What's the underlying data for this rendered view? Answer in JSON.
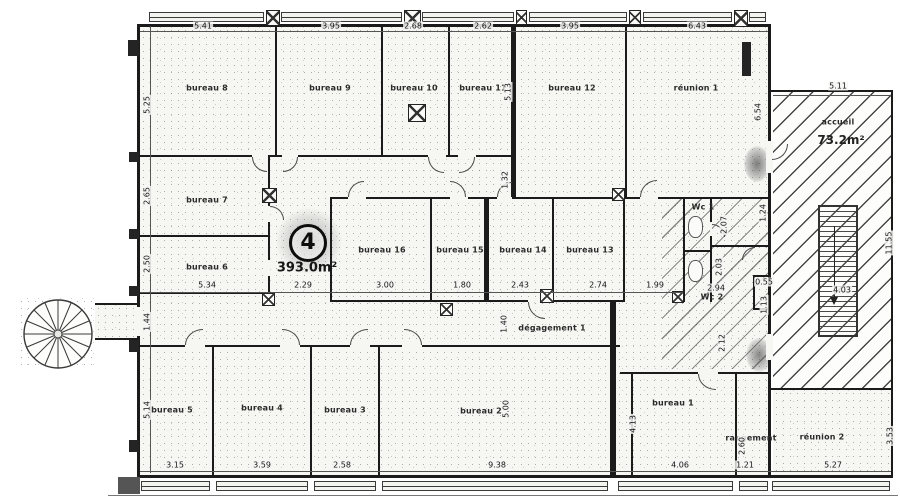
{
  "annotations": {
    "unit_number": "4",
    "unit_area": "393.0m²",
    "accueil_area": "73.2m²"
  },
  "colors": {
    "ink": "#1b1b1b",
    "paper": "#ffffff"
  },
  "rooms": [
    {
      "label": "bureau 8",
      "x": 207,
      "y": 88
    },
    {
      "label": "bureau 9",
      "x": 330,
      "y": 88
    },
    {
      "label": "bureau 10",
      "x": 414,
      "y": 88
    },
    {
      "label": "bureau 11",
      "x": 483,
      "y": 88
    },
    {
      "label": "bureau 12",
      "x": 572,
      "y": 88
    },
    {
      "label": "réunion 1",
      "x": 696,
      "y": 88
    },
    {
      "label": "bureau 7",
      "x": 207,
      "y": 200
    },
    {
      "label": "bureau 6",
      "x": 207,
      "y": 267
    },
    {
      "label": "bureau 16",
      "x": 382,
      "y": 250
    },
    {
      "label": "bureau 15",
      "x": 460,
      "y": 250
    },
    {
      "label": "bureau 14",
      "x": 523,
      "y": 250
    },
    {
      "label": "bureau 13",
      "x": 590,
      "y": 250
    },
    {
      "label": "Wc 1",
      "x": 703,
      "y": 207
    },
    {
      "label": "Wc 2",
      "x": 712,
      "y": 297
    },
    {
      "label": "dégagement 1",
      "x": 552,
      "y": 328
    },
    {
      "label": "bureau 5",
      "x": 172,
      "y": 410
    },
    {
      "label": "bureau 4",
      "x": 262,
      "y": 408
    },
    {
      "label": "bureau 3",
      "x": 345,
      "y": 410
    },
    {
      "label": "bureau 2",
      "x": 481,
      "y": 411
    },
    {
      "label": "bureau 1",
      "x": 673,
      "y": 403
    },
    {
      "label": "rangement",
      "x": 751,
      "y": 438
    },
    {
      "label": "réunion 2",
      "x": 822,
      "y": 437
    },
    {
      "label": "accueil",
      "x": 838,
      "y": 122
    }
  ],
  "dims": [
    {
      "t": "5.41",
      "x": 203,
      "y": 26
    },
    {
      "t": "3.95",
      "x": 331,
      "y": 26
    },
    {
      "t": "2.68",
      "x": 413,
      "y": 26
    },
    {
      "t": "2.62",
      "x": 483,
      "y": 26
    },
    {
      "t": "3.95",
      "x": 570,
      "y": 26
    },
    {
      "t": "6.43",
      "x": 697,
      "y": 26
    },
    {
      "t": "5.25",
      "x": 147,
      "y": 105,
      "r": 1
    },
    {
      "t": "2.65",
      "x": 147,
      "y": 196,
      "r": 1
    },
    {
      "t": "2.50",
      "x": 147,
      "y": 264,
      "r": 1
    },
    {
      "t": "1.44",
      "x": 147,
      "y": 322,
      "r": 1
    },
    {
      "t": "5.14",
      "x": 147,
      "y": 410,
      "r": 1
    },
    {
      "t": "5.34",
      "x": 207,
      "y": 285
    },
    {
      "t": "2.29",
      "x": 303,
      "y": 285
    },
    {
      "t": "3.00",
      "x": 385,
      "y": 285
    },
    {
      "t": "1.80",
      "x": 462,
      "y": 285
    },
    {
      "t": "2.43",
      "x": 520,
      "y": 285
    },
    {
      "t": "2.74",
      "x": 598,
      "y": 285
    },
    {
      "t": "1.99",
      "x": 655,
      "y": 285
    },
    {
      "t": "5.13",
      "x": 508,
      "y": 92,
      "r": 1
    },
    {
      "t": "1.32",
      "x": 505,
      "y": 180,
      "r": 1
    },
    {
      "t": "6.54",
      "x": 758,
      "y": 112,
      "r": 1
    },
    {
      "t": "1.24",
      "x": 763,
      "y": 213,
      "r": 1
    },
    {
      "t": "2.07",
      "x": 724,
      "y": 225,
      "r": 1
    },
    {
      "t": "2.03",
      "x": 719,
      "y": 267,
      "r": 1
    },
    {
      "t": "2.94",
      "x": 716,
      "y": 288
    },
    {
      "t": "0.55",
      "x": 764,
      "y": 282
    },
    {
      "t": "1.13",
      "x": 764,
      "y": 305,
      "r": 1
    },
    {
      "t": "2.12",
      "x": 722,
      "y": 343,
      "r": 1
    },
    {
      "t": "1.40",
      "x": 504,
      "y": 324,
      "r": 1
    },
    {
      "t": "5.00",
      "x": 506,
      "y": 409,
      "r": 1
    },
    {
      "t": "4.13",
      "x": 633,
      "y": 424,
      "r": 1
    },
    {
      "t": "2.60",
      "x": 742,
      "y": 446,
      "r": 1
    },
    {
      "t": "3.15",
      "x": 175,
      "y": 465
    },
    {
      "t": "3.59",
      "x": 262,
      "y": 465
    },
    {
      "t": "2.58",
      "x": 342,
      "y": 465
    },
    {
      "t": "9.38",
      "x": 497,
      "y": 465
    },
    {
      "t": "4.06",
      "x": 680,
      "y": 465
    },
    {
      "t": "1.21",
      "x": 745,
      "y": 465
    },
    {
      "t": "5.27",
      "x": 833,
      "y": 465
    },
    {
      "t": "3.53",
      "x": 890,
      "y": 436,
      "r": 1
    },
    {
      "t": "11.55",
      "x": 889,
      "y": 243,
      "r": 1
    },
    {
      "t": "5.11",
      "x": 838,
      "y": 86
    },
    {
      "t": "4.03",
      "x": 842,
      "y": 290
    }
  ]
}
